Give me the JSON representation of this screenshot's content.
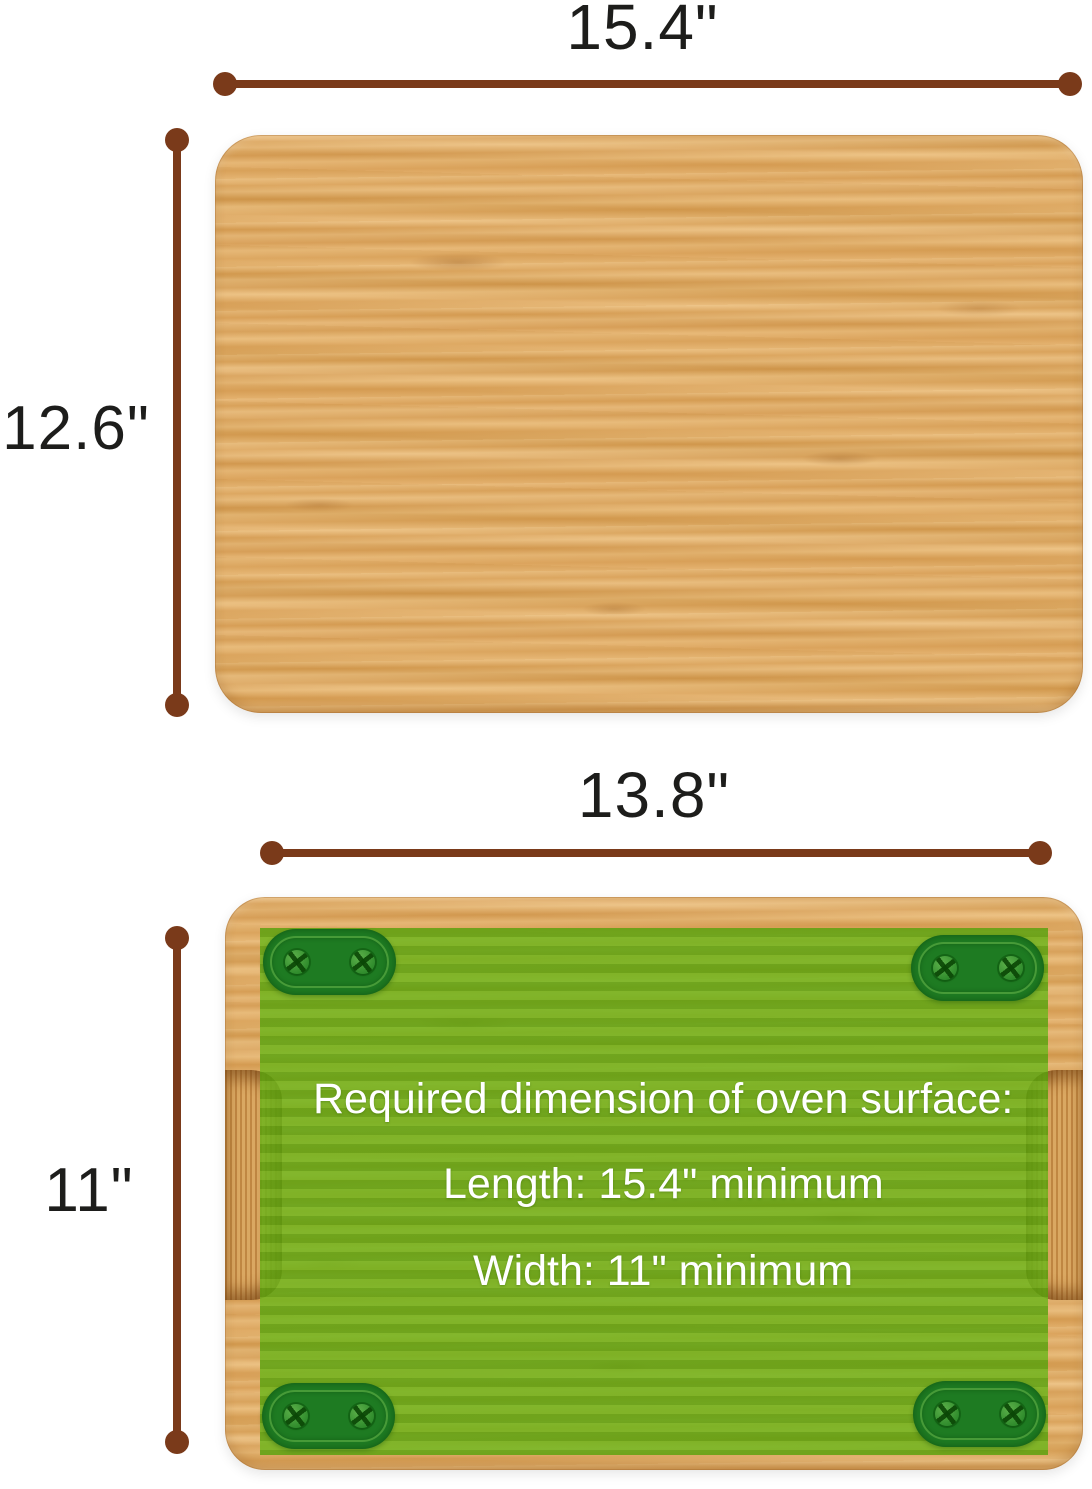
{
  "title": "Bamboo cutting board dimension diagram",
  "colors": {
    "background": "#ffffff",
    "line-brown": "#7a3a1a",
    "label-black": "#1d1d1b",
    "wood-base": "#dca55d",
    "green-overlay": "#65ae10",
    "foot-green": "#1e7b22",
    "text-white": "#ffffff"
  },
  "top_board": {
    "width_label": "15.4\"",
    "height_label": "12.6\""
  },
  "bottom_board": {
    "width_label": "13.8\"",
    "height_label": "11\"",
    "overlay": {
      "line1": "Required dimension of oven surface:",
      "line2": "Length: 15.4\" minimum",
      "line3": "Width: 11\" minimum"
    }
  }
}
